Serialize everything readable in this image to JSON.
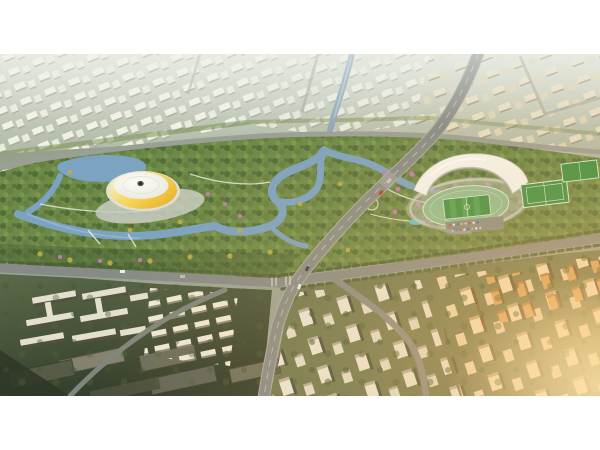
{
  "scene": {
    "kind": "aerial-architectural-render",
    "landmarks": [
      "gymnasium-dome-with-yellow-ring",
      "white-shell-stadium-with-athletics-track",
      "central-wetland-park",
      "winding-river",
      "residential-tower-districts",
      "courtyard-slab-district",
      "main-diagonal-avenue",
      "tree-lined-boulevard",
      "soccer-pitches",
      "parking-lot",
      "distant-hazy-cityscape",
      "sunset-glare-lower-right"
    ]
  },
  "colors": {
    "frame_white": "#ffffff",
    "city_base": "#9aa494",
    "haze_top": "#d6dbcd",
    "park_green": "#6d8a49",
    "forest_dark": "#4f6b36",
    "tree_light": "#7d9a4e",
    "tree_yellow": "#b9ad45",
    "flower_pink": "#c678b4",
    "water": "#7ca3c2",
    "water_light": "#a3c0d6",
    "road_primary": "#868b87",
    "road_minor": "#9aa096",
    "building_white": "#ece9db",
    "building_shadow": "#9b9788",
    "arena_yellow": "#f0c23c",
    "dome_white": "#fbfbf4",
    "oculus_dark": "#55554b",
    "stadium_roof": "#f4f6f1",
    "track_green": "#8fbd90",
    "pitch_green": "#3d9143",
    "ground_olive": "#6d7850",
    "ground_dark": "#39442f",
    "warm_glow": "#f7c074",
    "amber_tower": "#dba55e"
  }
}
